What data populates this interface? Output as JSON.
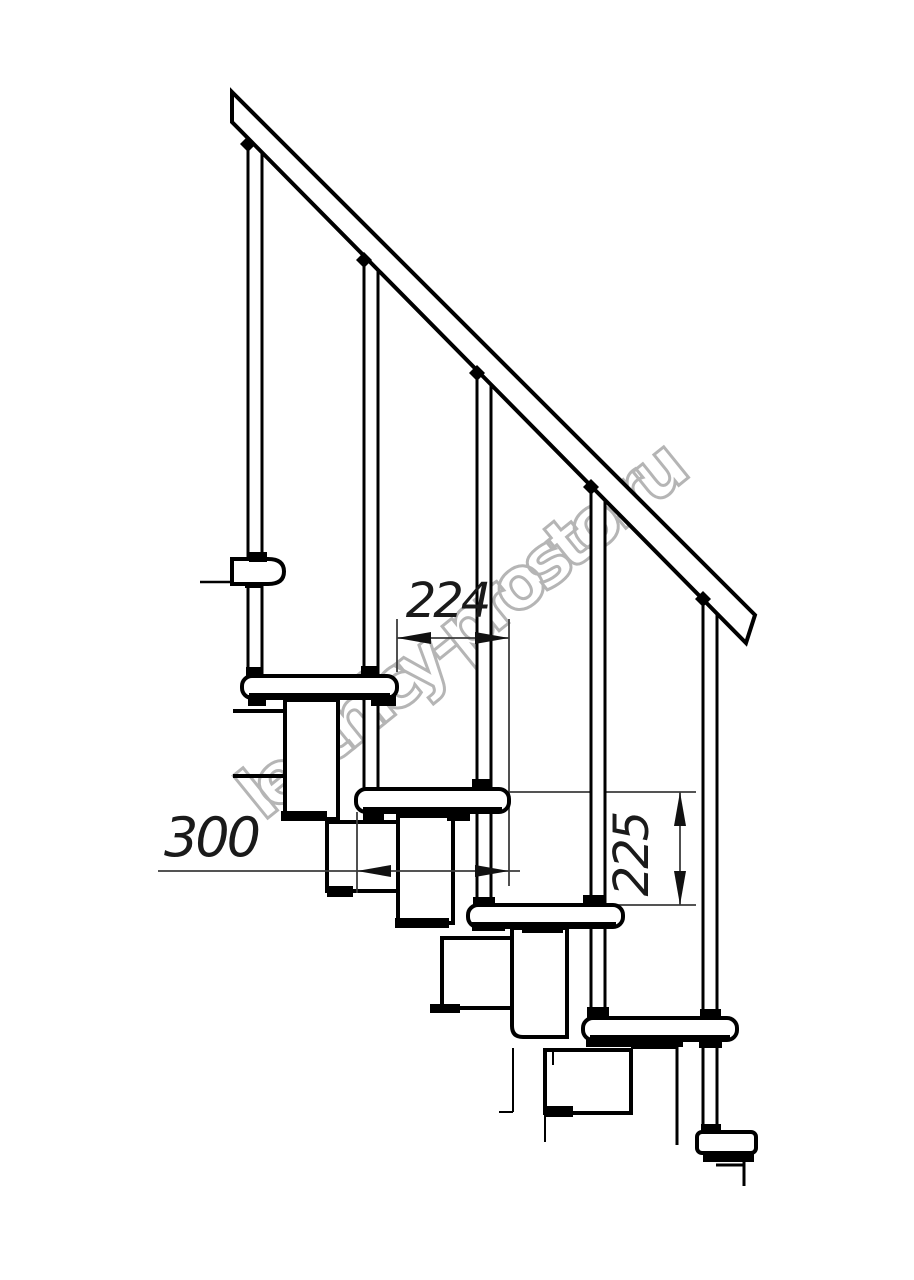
{
  "watermark": {
    "text": "lestnicy-prosto.ru"
  },
  "dimensions": {
    "tread_spacing": "224",
    "tread_depth": "300",
    "riser_height": "225"
  },
  "colors": {
    "line": "#000000",
    "dimension_line": "#3c3c3c",
    "dimension_text": "#1a1a1a",
    "watermark": "#b5b5b5",
    "background": "#ffffff"
  }
}
